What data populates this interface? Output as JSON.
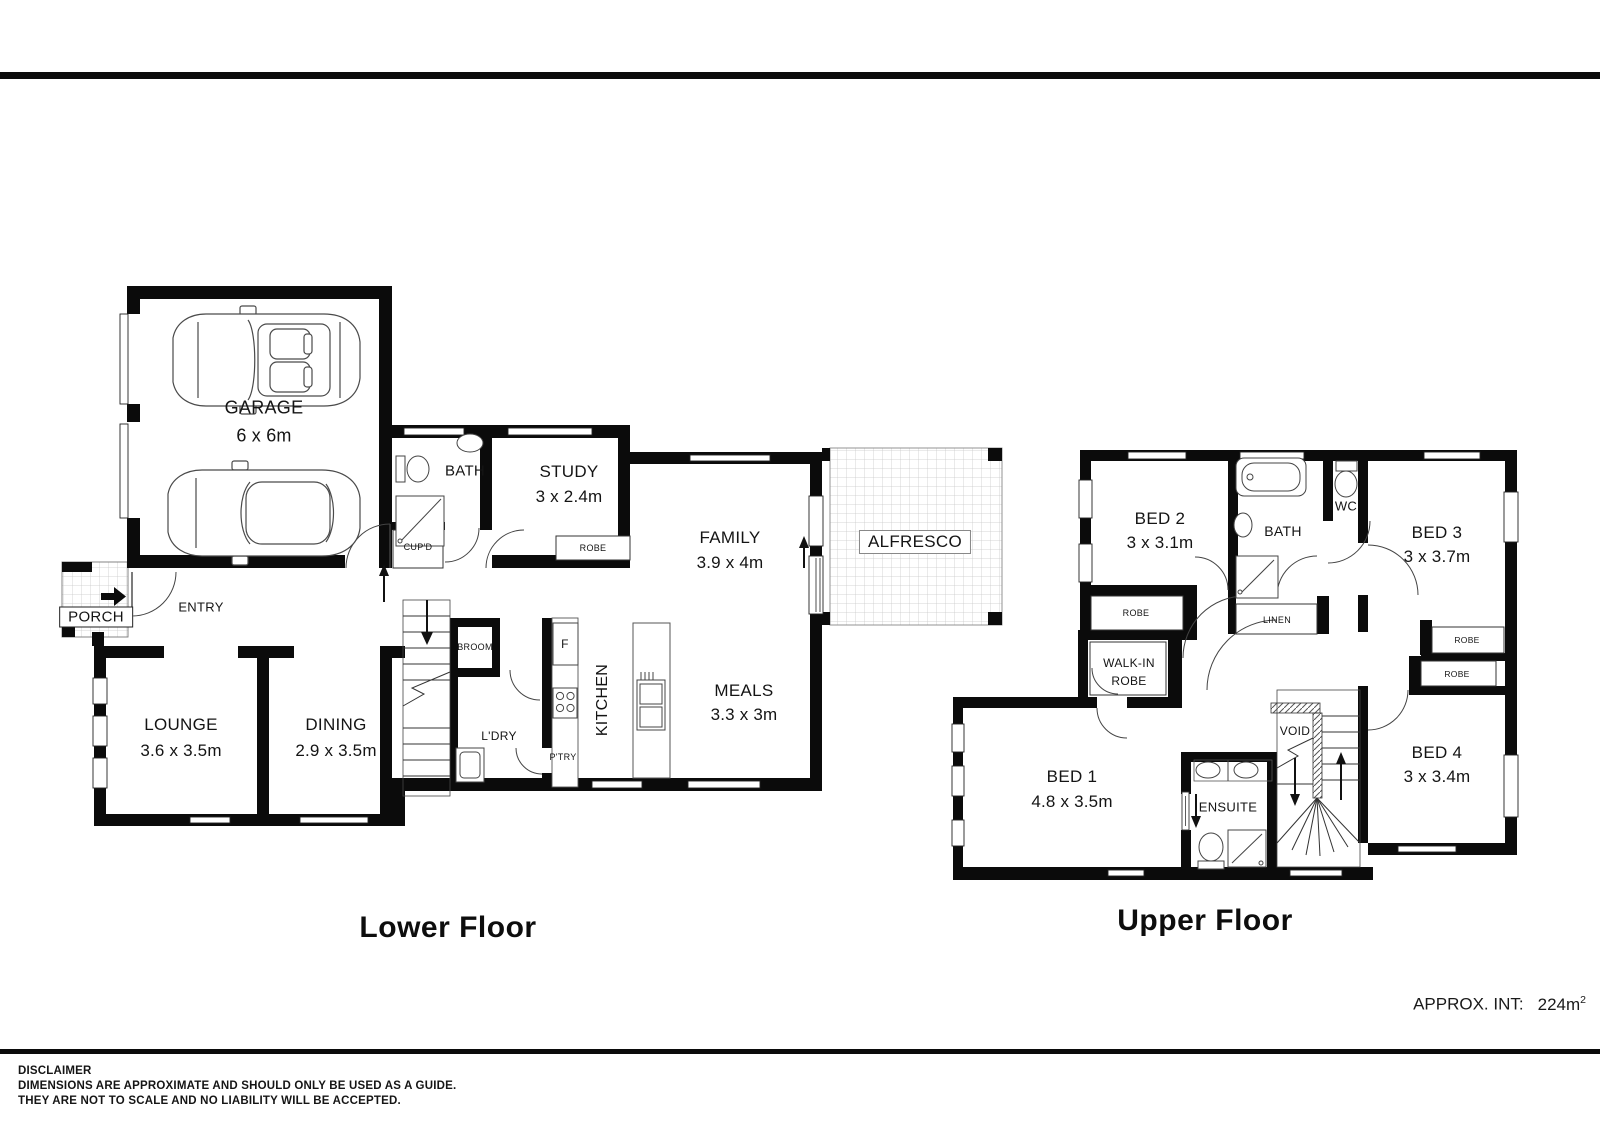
{
  "colors": {
    "ink": "#0b0b0b",
    "background": "#ffffff",
    "grid_line": "#c9c9c9"
  },
  "lower": {
    "title": "Lower Floor",
    "garage_label": "GARAGE",
    "garage_dims": "6 x 6m",
    "bath_label": "BATH",
    "cupd_label": "CUP'D",
    "study_label": "STUDY",
    "study_dims": "3 x 2.4m",
    "study_robe_label": "ROBE",
    "family_label": "FAMILY",
    "family_dims": "3.9 x 4m",
    "alfresco_label": "ALFRESCO",
    "porch_label": "PORCH",
    "entry_label": "ENTRY",
    "lounge_label": "LOUNGE",
    "lounge_dims": "3.6 x 3.5m",
    "dining_label": "DINING",
    "dining_dims": "2.9 x 3.5m",
    "broom_label": "BROOM",
    "ldry_label": "L'DRY",
    "fridge_label": "F",
    "kitchen_label": "KITCHEN",
    "ptry_label": "P'TRY",
    "meals_label": "MEALS",
    "meals_dims": "3.3 x 3m"
  },
  "upper": {
    "title": "Upper Floor",
    "bed1_label": "BED 1",
    "bed1_dims": "4.8 x 3.5m",
    "bed2_label": "BED 2",
    "bed2_dims": "3 x 3.1m",
    "bed3_label": "BED 3",
    "bed3_dims": "3 x 3.7m",
    "bed4_label": "BED 4",
    "bed4_dims": "3 x 3.4m",
    "bath_label": "BATH",
    "wc_label": "WC",
    "ensuite_label": "ENSUITE",
    "void_label": "VOID",
    "linen_label": "LINEN",
    "bed2_robe_label": "ROBE",
    "bed3_robe_label": "ROBE",
    "bed4_robe_label": "ROBE",
    "walkin_line1": "WALK-IN",
    "walkin_line2": "ROBE"
  },
  "footer": {
    "approx_label": "APPROX. INT:",
    "approx_value": "224m",
    "approx_sup": "2",
    "disclaimer_title": "DISCLAIMER",
    "disclaimer_line1": "DIMENSIONS ARE APPROXIMATE AND SHOULD ONLY BE USED AS A  GUIDE.",
    "disclaimer_line2": "THEY ARE NOT TO SCALE AND NO LIABILITY WILL BE ACCEPTED."
  }
}
